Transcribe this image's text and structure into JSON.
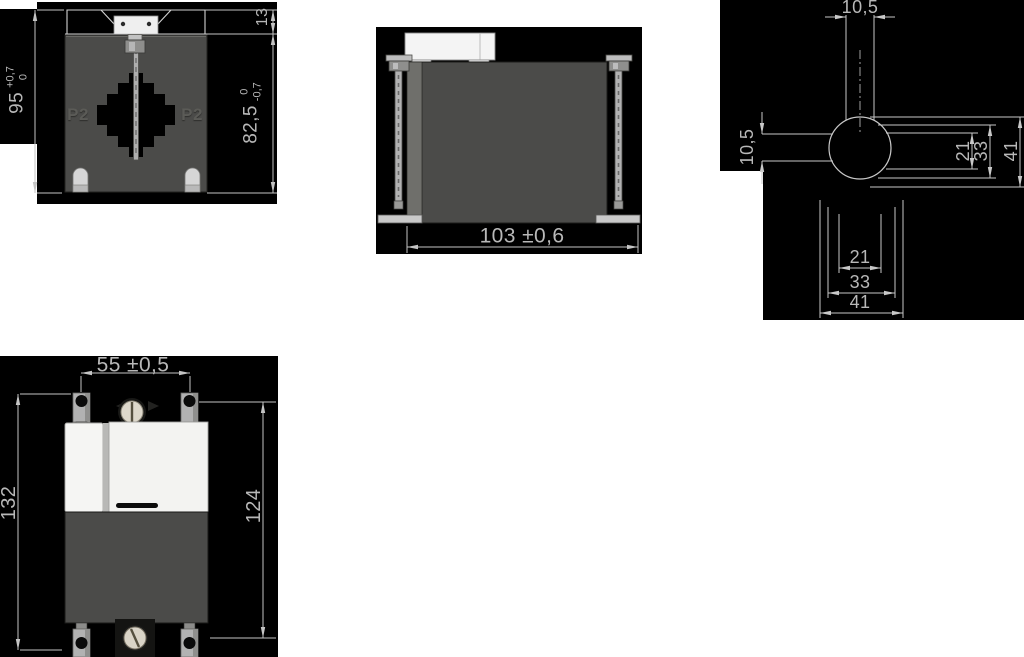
{
  "page": {
    "background": "#ffffff",
    "panel_color": "#000000",
    "line_color": "#c4c4c4",
    "text_color": "#b8b8b8",
    "body_color": "#4b4b49",
    "plastic_white": "#f3f3f1"
  },
  "views": {
    "front": {
      "dim_height": {
        "value": "95",
        "tol_upper": "+0,7",
        "tol_lower": "0"
      },
      "dim_bracket_height": {
        "value": "13"
      },
      "dim_body_height": {
        "value": "82,5",
        "tol_upper": "0",
        "tol_lower": "-0,7"
      },
      "label_p2_left": "P2",
      "label_p2_right": "P2"
    },
    "side": {
      "dim_width": {
        "value": "103 ±0,6"
      }
    },
    "hole_detail": {
      "dim_slot_width_top": "10,5",
      "dim_slot_width_left": "10,5",
      "dims_right": [
        "21",
        "33",
        "41"
      ],
      "dims_bottom": [
        "21",
        "33",
        "41"
      ]
    },
    "top": {
      "dim_terminal_spacing": "55 ±0,5",
      "dim_overall_length": "132",
      "dim_body_length": "124"
    }
  }
}
